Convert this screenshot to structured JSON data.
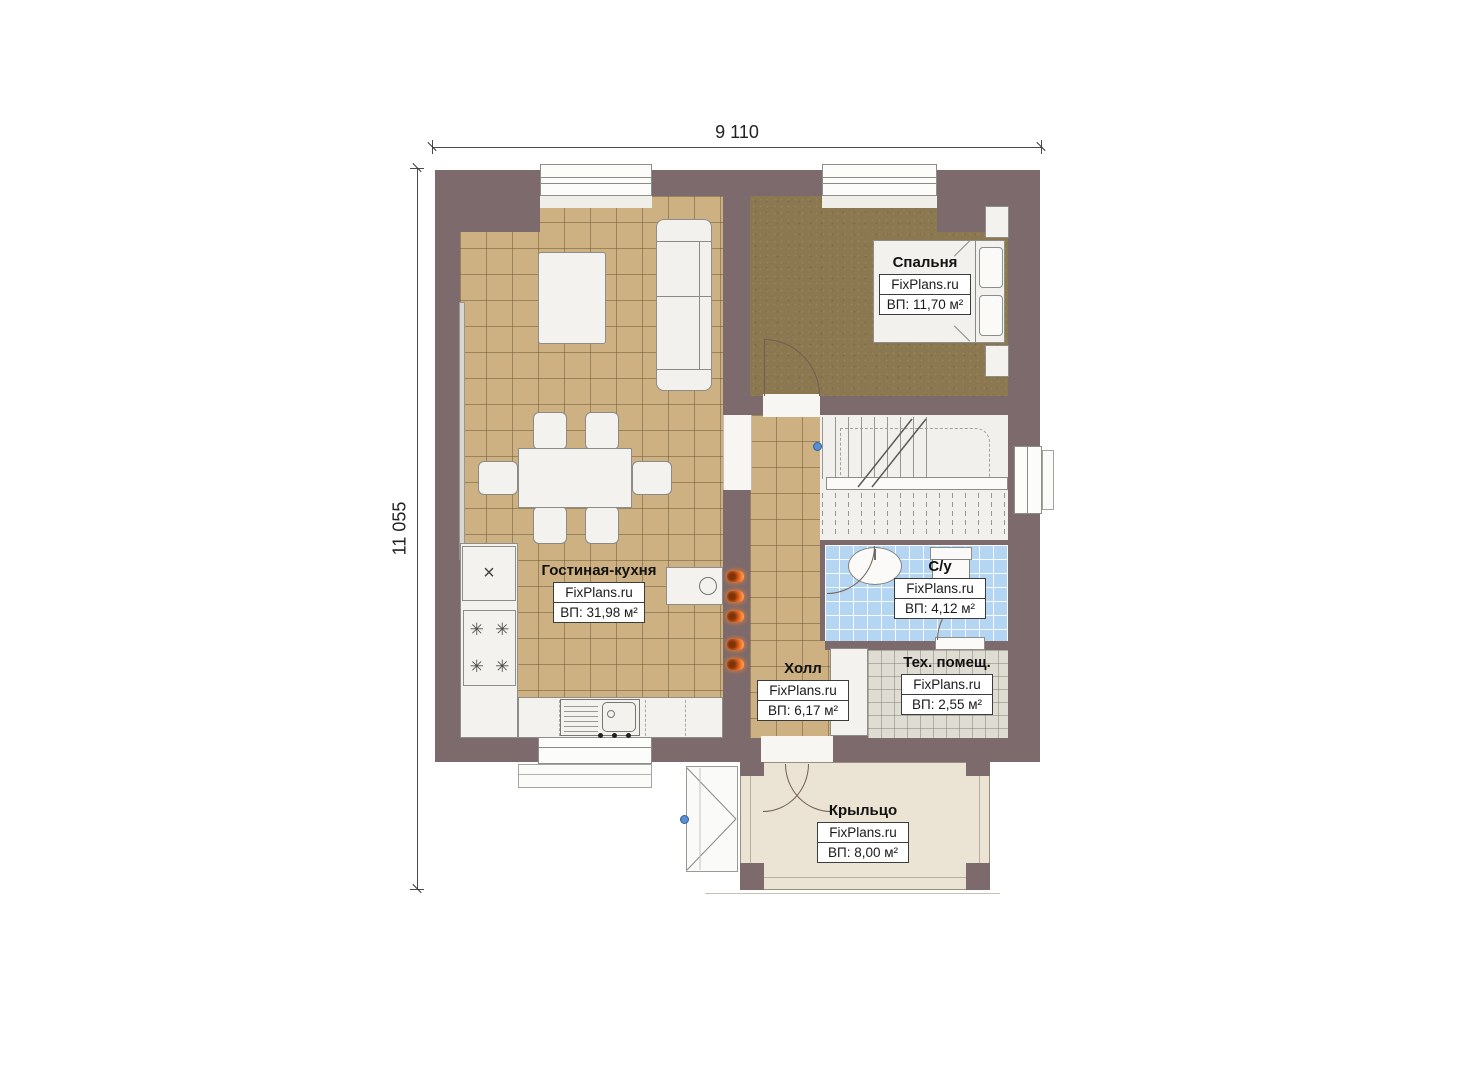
{
  "title": "Floor plan — first floor",
  "dimensions": {
    "width_top": "9 110",
    "height_left": "11 055"
  },
  "rooms": [
    {
      "name": "Гостиная-кухня",
      "brand": "FixPlans.ru",
      "area": "ВП: 31,98 м²"
    },
    {
      "name": "Спальня",
      "brand": "FixPlans.ru",
      "area": "ВП: 11,70 м²"
    },
    {
      "name": "С/у",
      "brand": "FixPlans.ru",
      "area": "ВП: 4,12 м²"
    },
    {
      "name": "Холл",
      "brand": "FixPlans.ru",
      "area": "ВП: 6,17 м²"
    },
    {
      "name": "Тех. помещ.",
      "brand": "FixPlans.ru",
      "area": "ВП: 2,55 м²"
    },
    {
      "name": "Крыльцо",
      "brand": "FixPlans.ru",
      "area": "ВП: 8,00 м²"
    }
  ],
  "symbols": {
    "fridge": "×",
    "burner": "✳"
  },
  "colors": {
    "wall": "#7d6a6c",
    "tile_floor": "#cdb183",
    "bedroom_floor": "#8b7850",
    "bath_floor": "#b5d6f2",
    "tech_floor": "#dedcd3",
    "porch_floor": "#ebe3d3",
    "hook_orange": "#e8611a",
    "marker_blue": "#5b8fd4"
  }
}
